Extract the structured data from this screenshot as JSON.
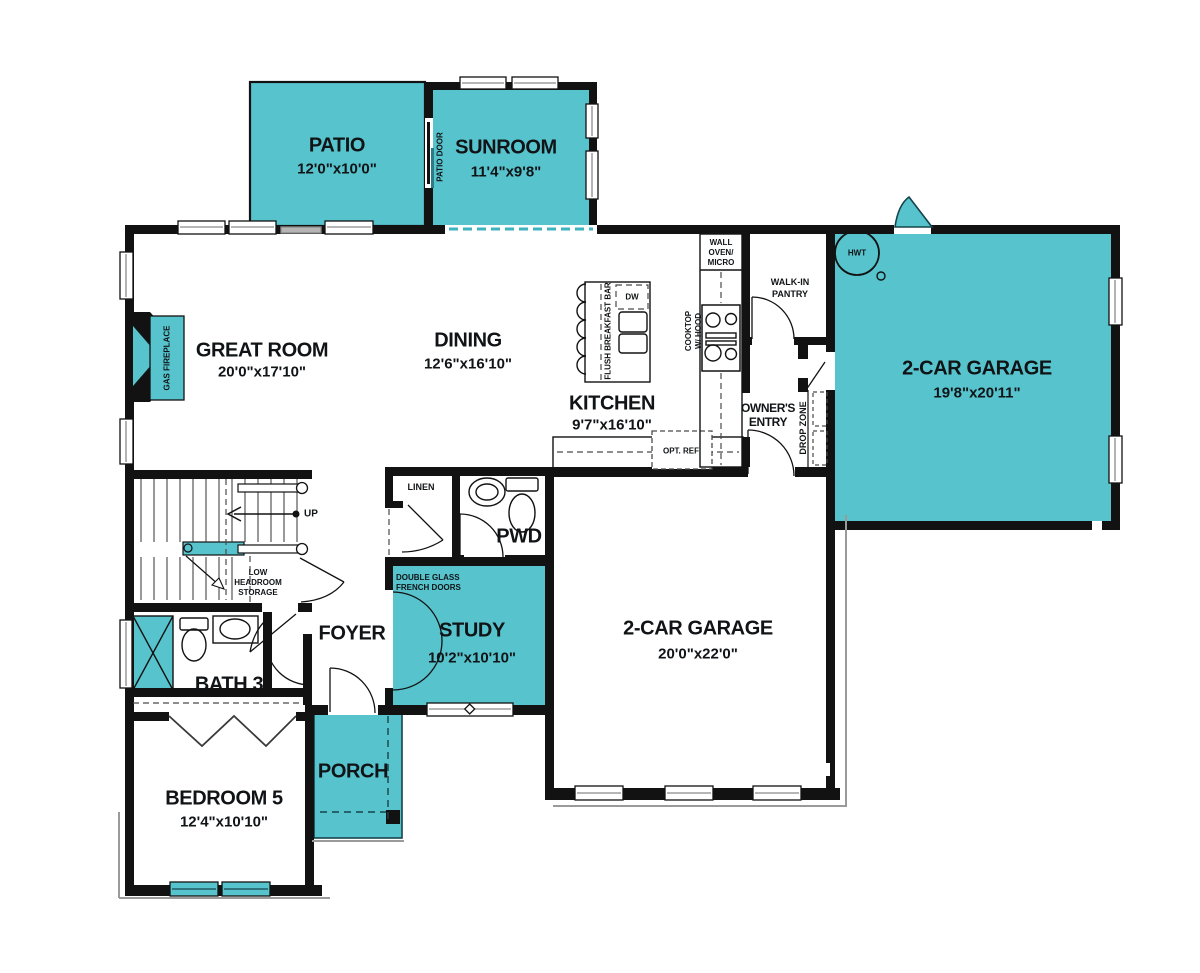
{
  "colors": {
    "teal": "#57c3cd",
    "wall": "#121212"
  },
  "rooms": {
    "patio": {
      "name": "PATIO",
      "dims": "12'0\"x10'0\""
    },
    "sunroom": {
      "name": "SUNROOM",
      "dims": "11'4\"x9'8\""
    },
    "great_room": {
      "name": "GREAT ROOM",
      "dims": "20'0\"x17'10\""
    },
    "dining": {
      "name": "DINING",
      "dims": "12'6\"x16'10\""
    },
    "kitchen": {
      "name": "KITCHEN",
      "dims": "9'7\"x16'10\""
    },
    "garage_right": {
      "name": "2-CAR GARAGE",
      "dims": "19'8\"x20'11\""
    },
    "garage_main": {
      "name": "2-CAR GARAGE",
      "dims": "20'0\"x22'0\""
    },
    "study": {
      "name": "STUDY",
      "dims": "10'2\"x10'10\""
    },
    "bedroom5": {
      "name": "BEDROOM 5",
      "dims": "12'4\"x10'10\""
    },
    "bath3": {
      "name": "BATH 3"
    },
    "pwd": {
      "name": "PWD"
    },
    "foyer": {
      "name": "FOYER"
    },
    "porch": {
      "name": "PORCH"
    }
  },
  "annotations": {
    "patio_door": "PATIO DOOR",
    "gas_fireplace": "GAS FIREPLACE",
    "flush_breakfast_bar": "FLUSH BREAKFAST BAR",
    "dw": "DW",
    "wall_oven_line1": "WALL",
    "wall_oven_line2": "OVEN/",
    "wall_oven_line3": "MICRO",
    "pantry_line1": "WALK-IN",
    "pantry_line2": "PANTRY",
    "cooktop_line1": "COOKTOP",
    "cooktop_line2": "W/ HOOD",
    "owners_line1": "OWNER'S",
    "owners_line2": "ENTRY",
    "drop_zone": "DROP ZONE",
    "opt_ref": "OPT. REF",
    "linen": "LINEN",
    "hwt": "HWT",
    "up": "UP",
    "low_line1": "LOW",
    "low_line2": "HEADROOM",
    "low_line3": "STORAGE",
    "french_line1": "DOUBLE GLASS",
    "french_line2": "FRENCH DOORS"
  }
}
